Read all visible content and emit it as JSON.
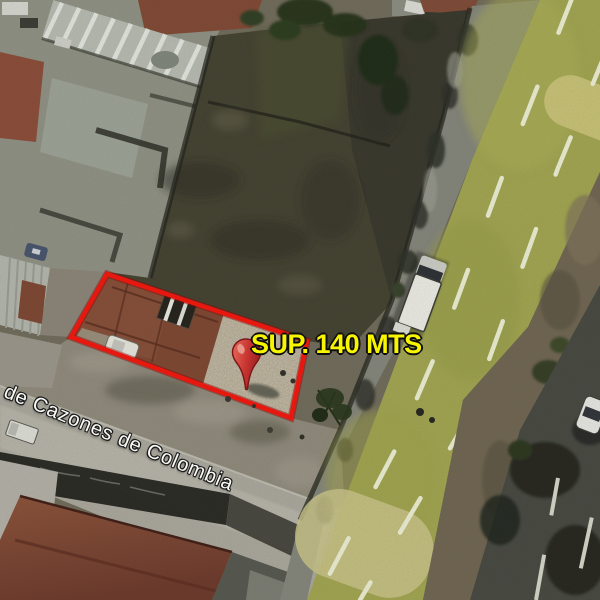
{
  "map": {
    "view": "satellite-aerial",
    "area_label": "SUP. 140 MTS",
    "street_label": "de Cazones de Colombia",
    "icons": {
      "marker": "location-pin"
    },
    "colors": {
      "parcel_boundary": "#f2130a",
      "pin_red": "#c1272d",
      "road_overlay": "#a0a44f",
      "area_label_color": "#f8f500",
      "street_label_color": "#fbfbf8"
    }
  }
}
